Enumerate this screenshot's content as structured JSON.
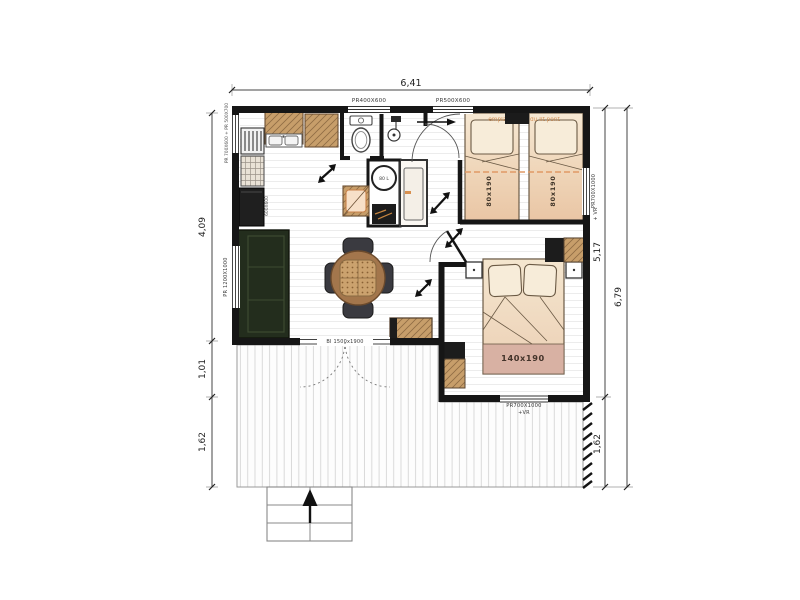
{
  "plan": {
    "dims": {
      "width_top": "6,41",
      "left_main": "4,09",
      "left_mid": "1,01",
      "left_terrace": "1,62",
      "right_main": "5,17",
      "right_terrace": "1,62",
      "right_total": "6,79"
    },
    "windows": {
      "top1": "PR400X600",
      "top2": "PR500X600",
      "left1": "PR 700X600 + PR 500X700",
      "left2": "PR 1200X1000",
      "right1": "PR700X1000",
      "right1_suffix": "+ VR",
      "bottom1": "PR700X1000",
      "bottom1_suffix": "+VR",
      "bay": "BI 1500x1900"
    },
    "furniture": {
      "twin_bed_1": "80x190",
      "twin_bed_2": "80x190",
      "double_bed": "140x190",
      "water_heater": "80 L",
      "fridge": "600X600",
      "bunk_note": "emplacement du lit pont"
    }
  }
}
